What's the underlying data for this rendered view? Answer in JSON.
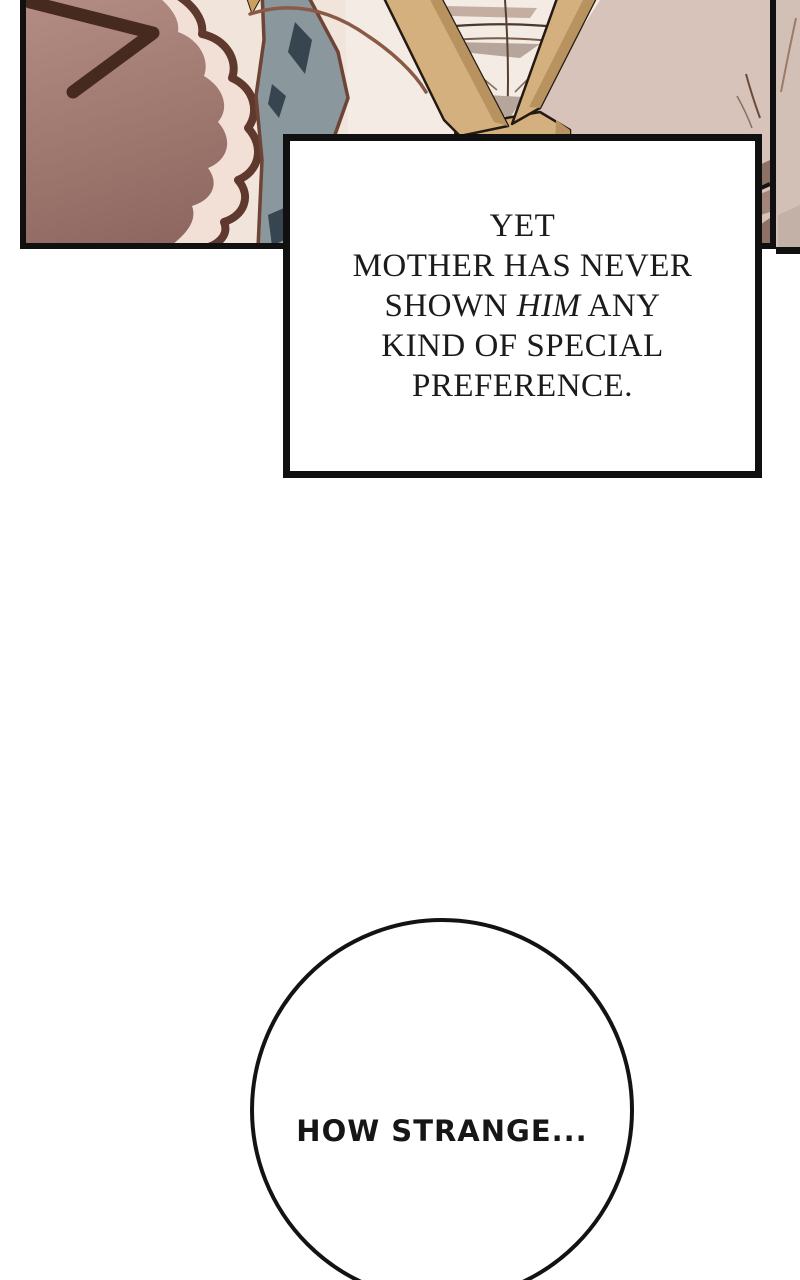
{
  "comic_panel": {
    "border_color": "#101010",
    "colors": {
      "bg_cream": "#f0e4db",
      "bg_right_taupe": "#d7c3ba",
      "shirt": "#f3ebe4",
      "hair_base_light": "#b28c82",
      "hair_base_dark": "#8f6861",
      "hair_highlight": "#f2e0d6",
      "hair_outline": "#5f392e",
      "chevron": "#46291f",
      "rock_base": "#8a979c",
      "rock_facet": "#36454f",
      "rock_outline": "#6f4336",
      "strand": "#8a5a44",
      "strand_tip": "#c9a05e",
      "strap": "#d3b07e",
      "strap_shadow": "#b8925f",
      "strap_outline": "#241a12",
      "wrinkle_dark": "#4a382b",
      "wrinkle_soft": "#7a5c4a",
      "shadow_wedge": "#b5a59a",
      "collar_taupe": "#c4ada1",
      "arm_patch": "#8d7164",
      "arm_patch_light": "#a18679",
      "side_strip": "#d2c0b7",
      "side_crease": "#9c7a66"
    }
  },
  "narration_box": {
    "line1": "YET",
    "line2": "MOTHER HAS NEVER",
    "line3_pre": "SHOWN ",
    "line3_italic": "HIM",
    "line3_post": " ANY",
    "line4": "KIND OF SPECIAL",
    "line5": "PREFERENCE.",
    "text_color": "#1b1b1b",
    "border_color": "#101010"
  },
  "speech_bubble": {
    "text": "HOW STRANGE...",
    "text_color": "#161616",
    "border_color": "#131313"
  }
}
